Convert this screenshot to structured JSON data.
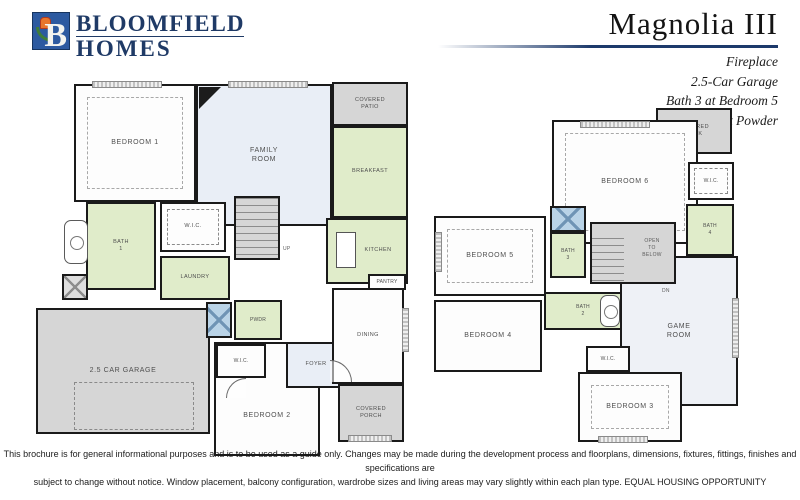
{
  "header": {
    "logo": {
      "monogram": "B",
      "line1": "BLOOMFIELD",
      "line2": "HOMES",
      "icon": "tulip-b-logo"
    },
    "plan_name": "Magnolia III",
    "features": [
      "Fireplace",
      "2.5-Car Garage",
      "Bath 3 at Bedroom 5",
      "Shower at Powder"
    ]
  },
  "colors": {
    "brand_navy": "#1f3a66",
    "logo_blue": "#2d5aa0",
    "room_green": "#e0ecca",
    "room_blue": "#e9eef6",
    "room_gray": "#d6d6d6",
    "shower_blue": "#b9d3e7",
    "wall_black": "#1a1a1a"
  },
  "floor1": {
    "rooms": {
      "bedroom1": "BEDROOM 1",
      "family_room": "FAMILY\nROOM",
      "covered_patio": "COVERED\nPATIO",
      "breakfast": "BREAKFAST",
      "kitchen": "KITCHEN",
      "bath1": "BATH\n1",
      "wic": "W.I.C.",
      "laundry": "LAUNDRY",
      "powder": "PWDR",
      "pantry": "PANTRY",
      "garage": "2.5 CAR GARAGE",
      "bedroom2": "BEDROOM 2",
      "bedroom2_wic": "W.I.C.",
      "foyer": "FOYER",
      "dining": "DINING",
      "covered_porch": "COVERED\nPORCH",
      "stairs_up": "UP"
    }
  },
  "floor2": {
    "rooms": {
      "bedroom6": "BEDROOM 6",
      "covered_deck": "COVERED\nDECK",
      "bedroom6_wic": "W.I.C.",
      "bath4": "BATH\n4",
      "bedroom5": "BEDROOM 5",
      "bath3": "BATH\n3",
      "open_to_below": "OPEN\nTO\nBELOW",
      "stairs_dn": "DN",
      "bedroom4": "BEDROOM 4",
      "bath2": "BATH\n2",
      "game_room": "GAME\nROOM",
      "bedroom3": "BEDROOM 3",
      "bedroom3_wic": "W.I.C."
    }
  },
  "footer": {
    "line1": "This brochure is for general informational purposes and is to be used as a guide only. Changes may be made during the development process and floorplans, dimensions, fixtures, fittings, finishes and specifications are",
    "line2": "subject to change without notice. Window placement, balcony configuration, wardrobe sizes and living areas may vary slightly within each plan type.  EQUAL HOUSING OPPORTUNITY"
  }
}
